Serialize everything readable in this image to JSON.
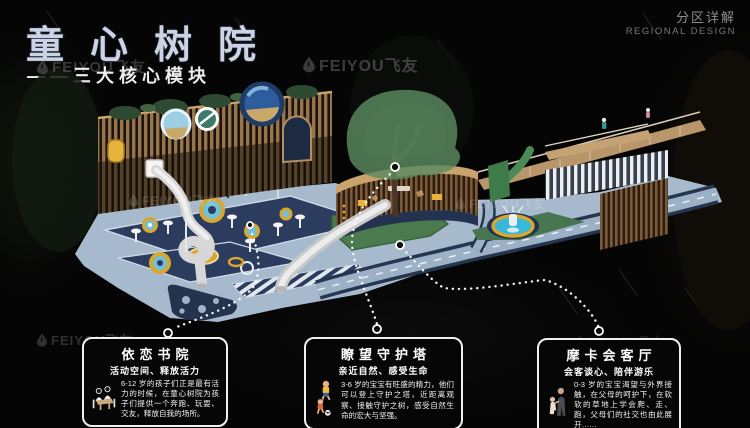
{
  "header": {
    "title": "童心树院",
    "subtitle": "——三大核心模块",
    "corner_label_cn": "分区详解",
    "corner_label_en": "REGIONAL DESIGN"
  },
  "watermark": {
    "brand": "FEIYOU飞友",
    "logo": "feiyou-droplet-icon"
  },
  "modules": [
    {
      "title": "依恋书院",
      "tagline": "活动空间、释放活力",
      "description": "6-12 岁的孩子们正是最有活力的时候，在童心树院为孩子们提供一个奔跑、玩耍、交友，释放自我的场所。",
      "icon": "reading-children-icon",
      "age_group": "6-12"
    },
    {
      "title": "瞭望守护塔",
      "tagline": "亲近自然、感受生命",
      "description": "3-6 岁的宝宝有旺盛的精力，他们可以登上守护之塔，近距离观察、接触守护之树，感受自然生命的宏大与坚强。",
      "icon": "soccer-children-icon",
      "age_group": "3-6"
    },
    {
      "title": "摩卡会客厅",
      "tagline": "会客谈心、陪伴游乐",
      "description": "0-3 岁的宝宝渴望与外界接触，在父母的呵护下，在软软的草地上学会爬、走、跑，父母们的社交也由此展开……",
      "icon": "parent-child-icon",
      "age_group": "0-3"
    }
  ],
  "colors": {
    "background": "#050505",
    "title": "#ccd3e6",
    "deck": "#a7bacd",
    "navy": "#2c3c5e",
    "gold": "#d9a62e",
    "wood": "#96744c",
    "tree": "#5c8a5f",
    "pool": "#35b8da",
    "callout_border": "#f0f0f0"
  }
}
